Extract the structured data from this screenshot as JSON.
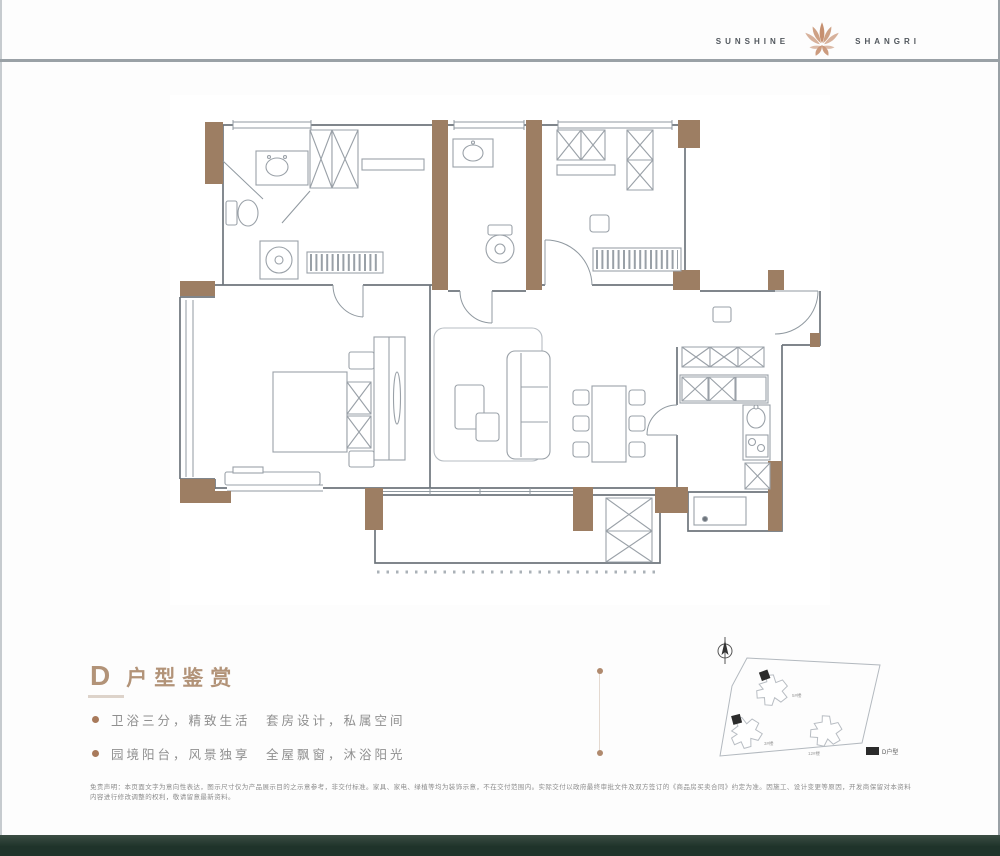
{
  "brand": {
    "word_left": "SUNSHINE",
    "word_right": "SHANGRI",
    "logo_color": "#c69070"
  },
  "section": {
    "letter": "D",
    "title": "户型鉴赏",
    "features": [
      "卫浴三分，精致生活　套房设计，私属空间",
      "园境阳台，风景独享　全屋飘窗，沐浴阳光"
    ]
  },
  "siteplan": {
    "legend": "D户型",
    "buildings": [
      "5#楼",
      "3#楼",
      "12#楼"
    ]
  },
  "disclaimer": {
    "line1": "免责声明：本页面文字为意向性表达，图示尺寸仅为产品展示目的之示意参考，非交付标准。家具、家电、绿植等均为装饰示意，不在交付范围内。实际交付以政府最终审批文件及双方签订的《商品房买卖合同》约定为准。因施工、设计变更等原因，开发商保留对本资料",
    "line2": "内容进行修改调整的权利，敬请留意最新资料。"
  },
  "colors": {
    "wall_brown": "#9d7e63",
    "title_tan": "#b29378",
    "accent_bullet": "#a87a5b",
    "footer_green": "#22362d",
    "rule_gray": "#9aa1a6"
  }
}
